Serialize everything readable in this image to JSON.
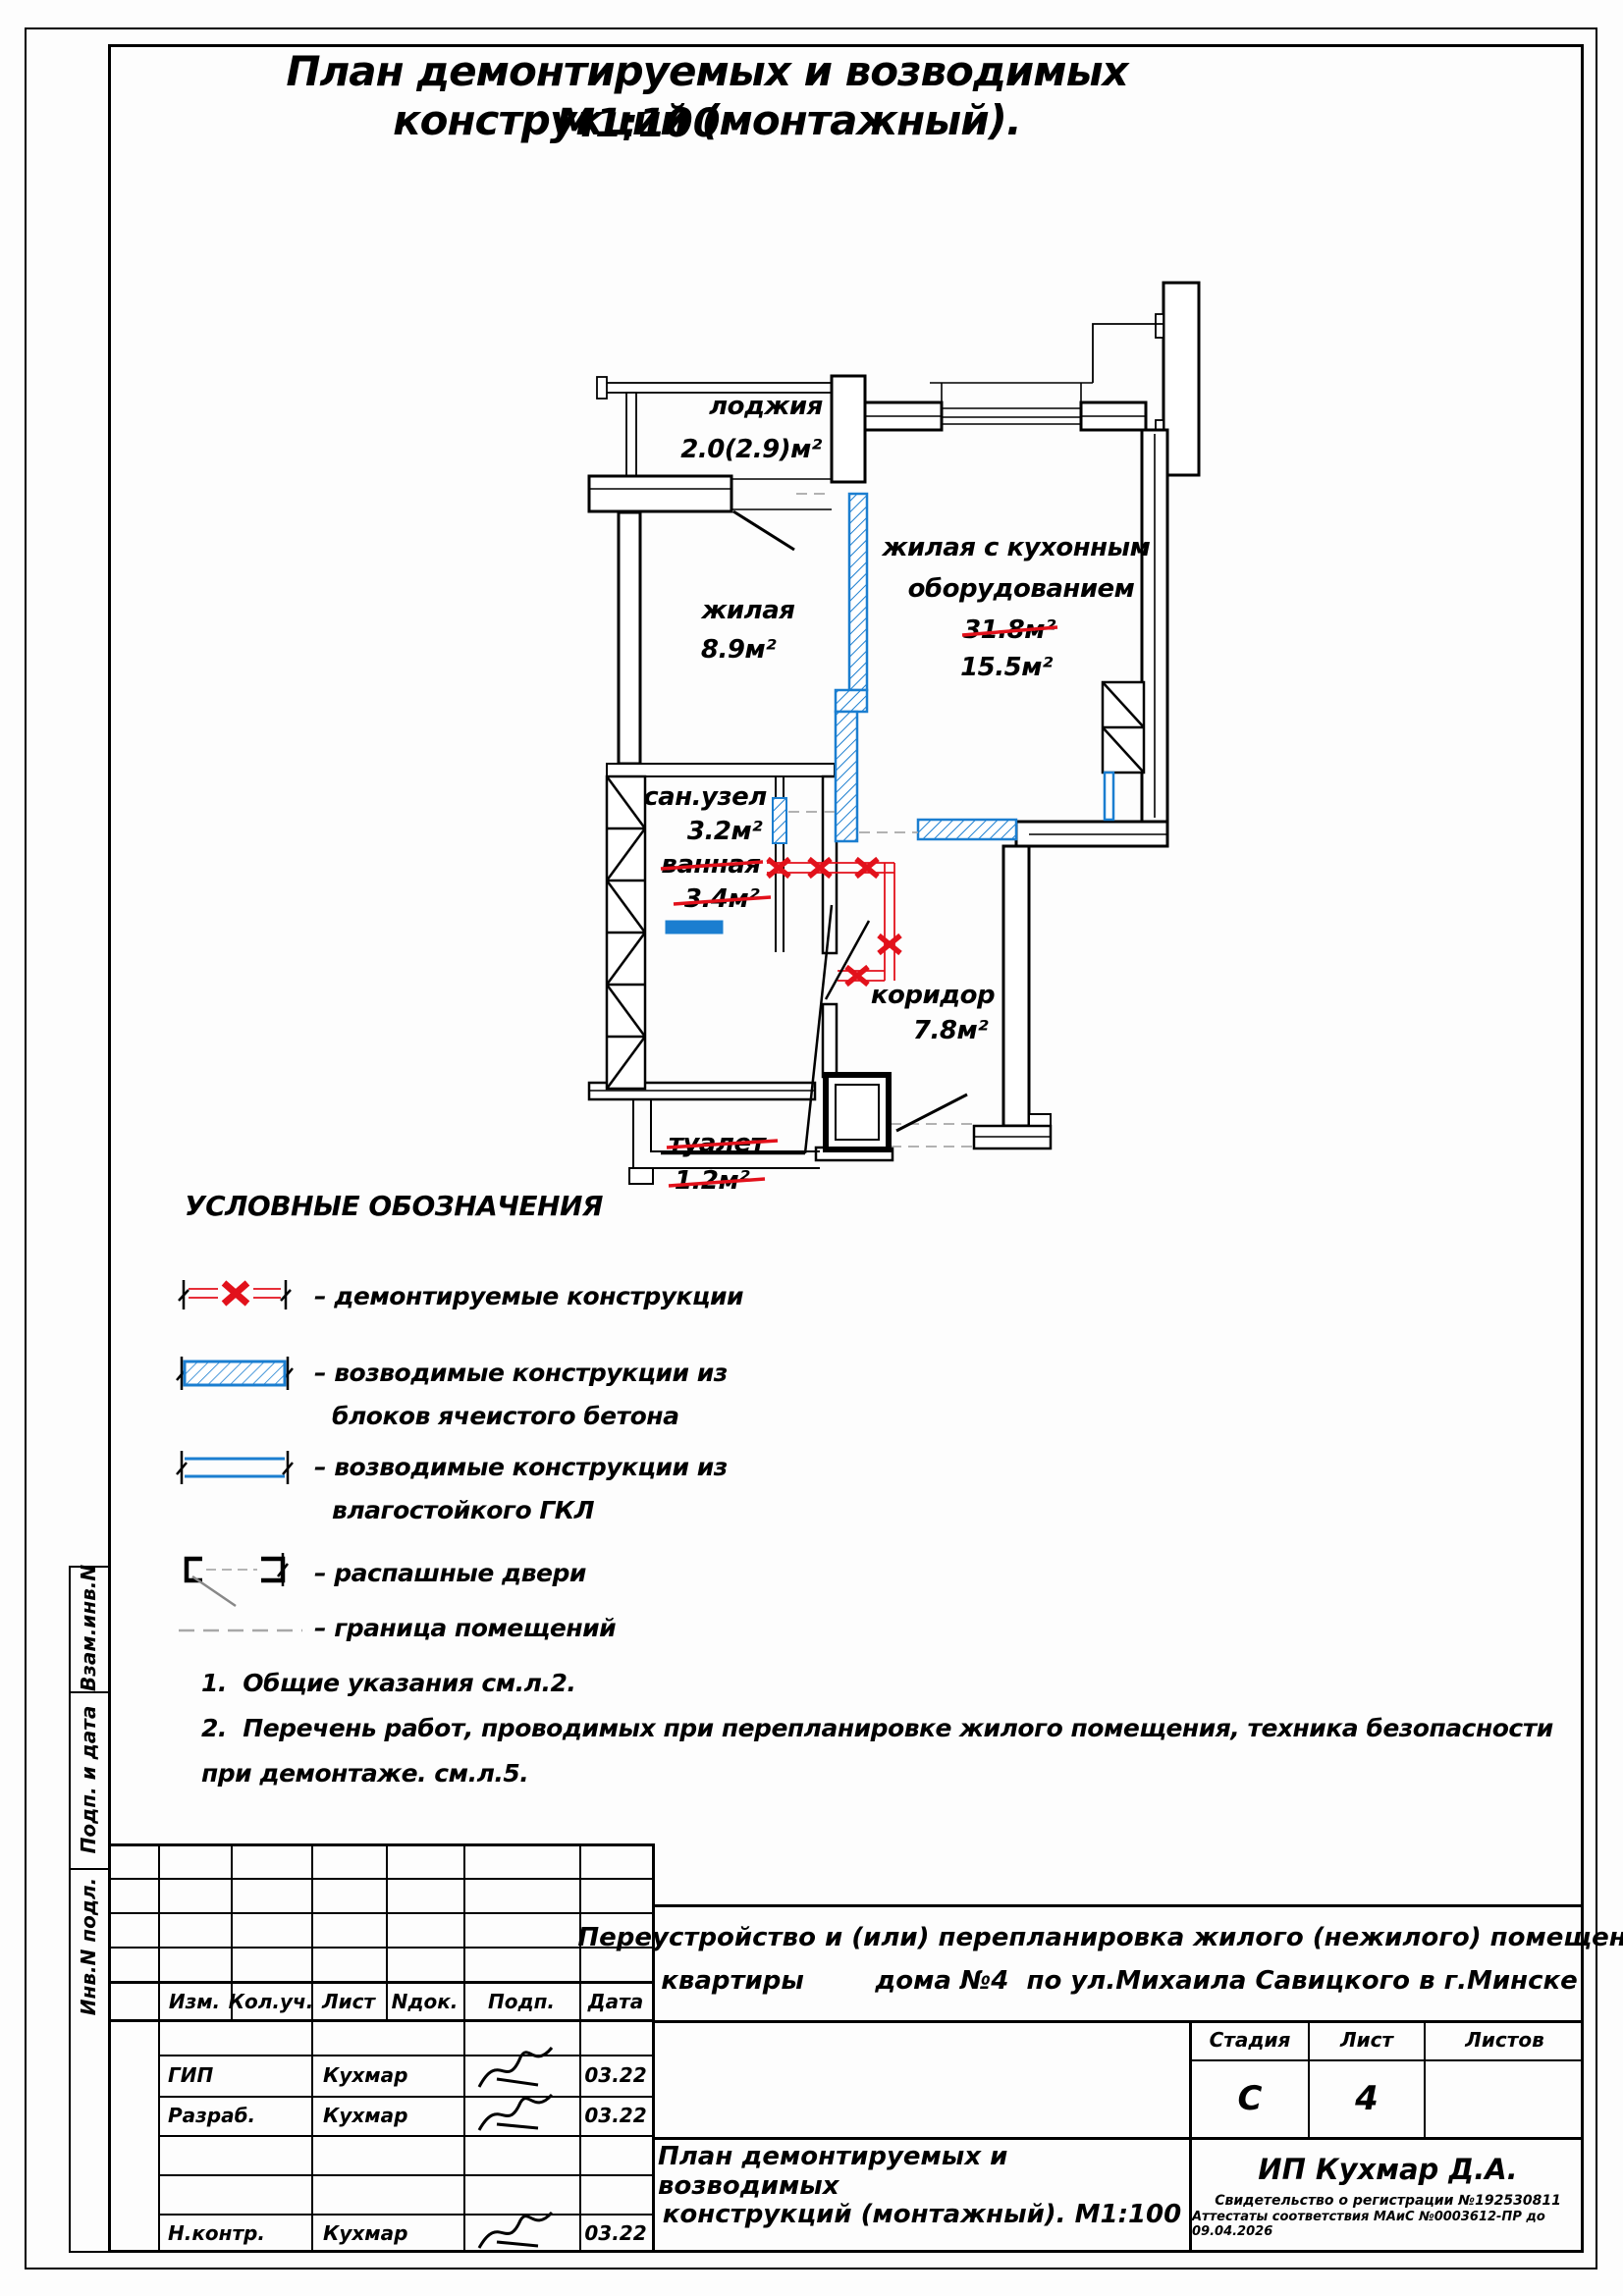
{
  "sheet": {
    "title": "План демонтируемых и возводимых конструкций (монтажный).",
    "scale": "М1:100"
  },
  "plan": {
    "rooms": [
      {
        "id": "loggia",
        "name": "лоджия",
        "area": "2.0(2.9)м²"
      },
      {
        "id": "living",
        "name": "жилая",
        "area": "8.9м²"
      },
      {
        "id": "kitchen-living",
        "name_line1": "жилая с кухонным",
        "name_line2": "оборудованием",
        "area_old": "31.8м²",
        "area_new": "15.5м²"
      },
      {
        "id": "san-uzel",
        "name": "сан.узел",
        "area": "3.2м²",
        "old_name": "ванная",
        "old_area": "3.4м²"
      },
      {
        "id": "toilet",
        "old_name": "туалет",
        "old_area": "1.2м²"
      },
      {
        "id": "corridor",
        "name": "коридор",
        "area": "7.8м²"
      }
    ]
  },
  "legend": {
    "heading": "УСЛОВНЫЕ ОБОЗНАЧЕНИЯ",
    "items": [
      {
        "icon": "demolished-walls-symbol",
        "label": "– демонтируемые конструкции"
      },
      {
        "icon": "aerated-concrete-symbol",
        "label_line1": "– возводимые конструкции из",
        "label_line2": "блоков ячеистого бетона"
      },
      {
        "icon": "gkl-wall-symbol",
        "label_line1": "– возводимые конструкции из",
        "label_line2": "влагостойкого ГКЛ"
      },
      {
        "icon": "swing-doors-symbol",
        "label": "– распашные двери"
      },
      {
        "icon": "room-boundary-symbol",
        "label": "– граница помещений"
      }
    ]
  },
  "notes": [
    "1.  Общие указания см.л.2.",
    "2.  Перечень работ, проводимых при перепланировке жилого помещения, техника безопасности",
    "при демонтаже. см.л.5."
  ],
  "title_block": {
    "columns": [
      "Изм.",
      "Кол.уч.",
      "Лист",
      "Nдок.",
      "Подп.",
      "Дата"
    ],
    "rows": [
      {
        "role": "ГИП",
        "name": "Кухмар",
        "date": "03.22"
      },
      {
        "role": "Разраб.",
        "name": "Кухмар",
        "date": "03.22"
      },
      {
        "role": "Н.контр.",
        "name": "Кухмар",
        "date": "03.22"
      }
    ],
    "project_line1": "Переустройство и (или) перепланировка жилого (нежилого) помещения",
    "project_line2": "квартиры        дома №4  по ул.Михаила Савицкого в г.Минске",
    "stage_label": "Стадия",
    "sheet_label": "Лист",
    "sheets_label": "Листов",
    "stage": "С",
    "sheet_no": "4",
    "sheets_total": "",
    "drawing_title_line1": "План демонтируемых и возводимых",
    "drawing_title_line2": "конструкций (монтажный). М1:100",
    "org": "ИП Кухмар Д.А.",
    "org_cert1": "Свидетельство о регистрации №192530811",
    "org_cert2": "Аттестаты соответствия МАиС №0003612-ПР до  09.04.2026"
  },
  "side_stamps": [
    "Взам.инв.N",
    "Подп. и дата",
    "Инв.N подл."
  ],
  "colors": {
    "new_wall_blue": "#1b7ed0",
    "demolition_red": "#e2111b",
    "boundary_gray": "#a8a8a8"
  }
}
